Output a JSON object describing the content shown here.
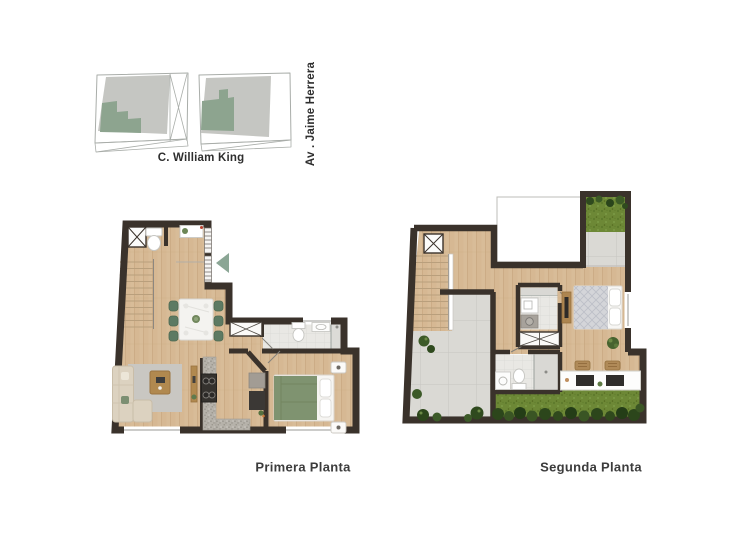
{
  "sheet": {
    "site_plan": {
      "street_label_bottom": "C. William King",
      "street_label_right": "Av . Jaime Herrera"
    },
    "plans": [
      {
        "label": "Primera Planta"
      },
      {
        "label": "Segunda Planta"
      }
    ],
    "colors": {
      "wall": "#3a322b",
      "wood_floor": "#d8bc98",
      "bathroom_tile": "#e8e7e3",
      "terrace_tile": "#dad9d4",
      "grass": "#6d8836",
      "accent_green": "#8ba695",
      "map_block_gray": "#c5c6c2",
      "map_highlight_green": "#8da48f"
    }
  }
}
